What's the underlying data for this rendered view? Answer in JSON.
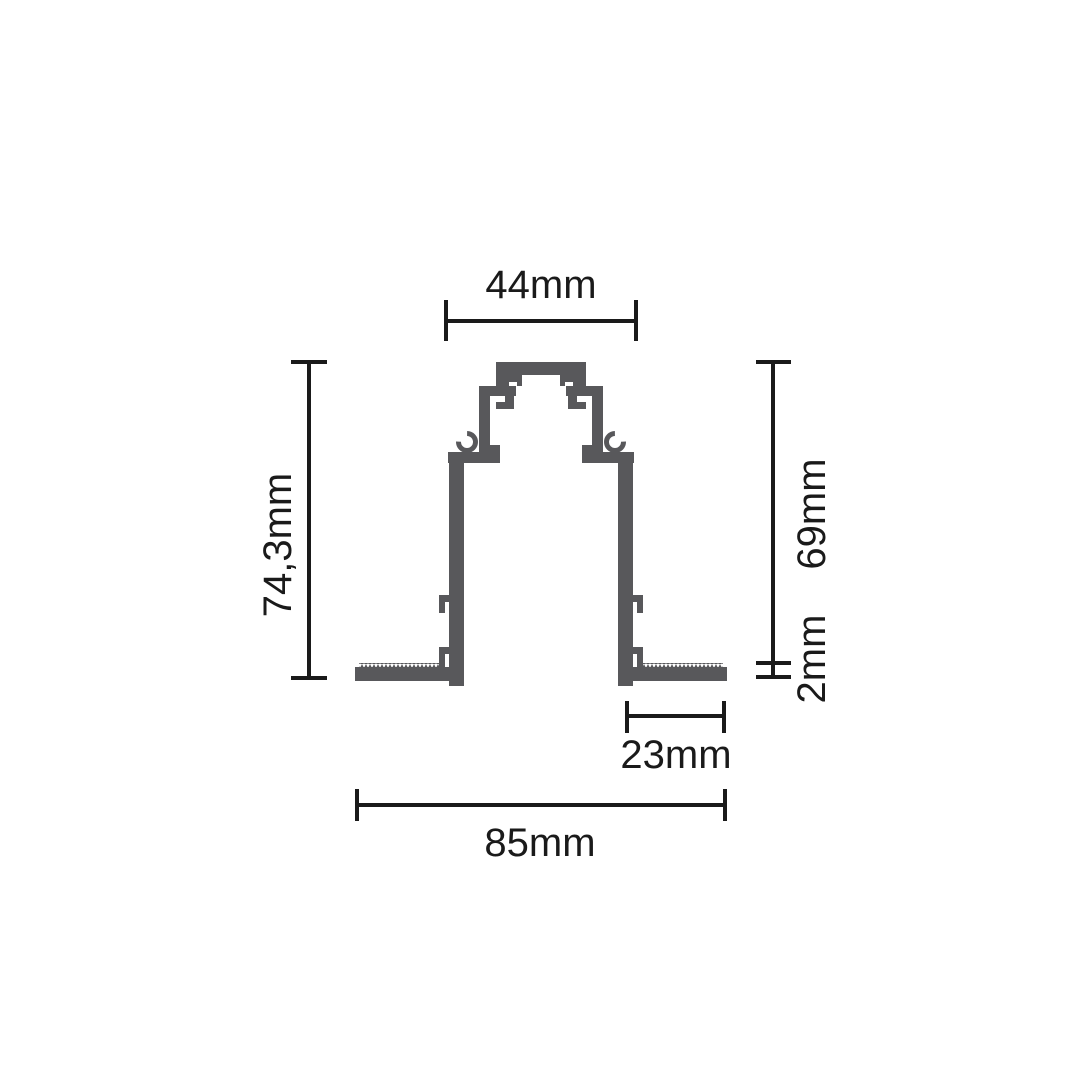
{
  "diagram": {
    "type": "technical_cross_section_drawing",
    "subject": "recessed-magnetic-track-aluminum-profile",
    "colors": {
      "profile": "#58585b",
      "line": "#1a1a1a",
      "background": "#ffffff"
    },
    "dimensions": {
      "top_width": "44mm",
      "total_height": "74,3mm",
      "upper_height": "69mm",
      "flange_thickness": "2mm",
      "flange_width": "23mm",
      "total_width": "85mm"
    }
  }
}
